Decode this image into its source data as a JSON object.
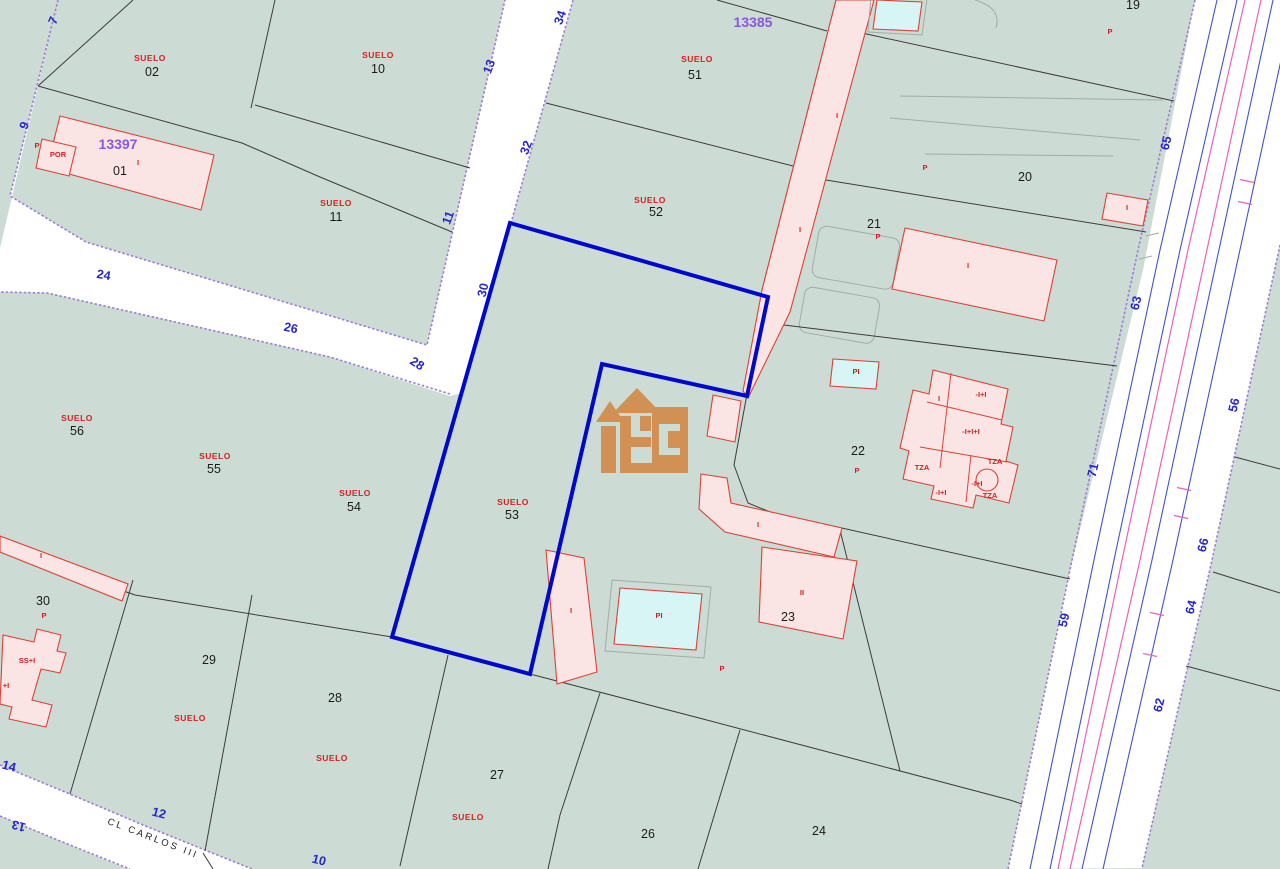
{
  "map": {
    "title": "cadastral-parcel-map",
    "selected_parcel": "53",
    "street_name": "CL CARLOS III",
    "block_codes": [
      "13397",
      "13385"
    ],
    "colors": {
      "parcel-green": "#ccdcd4",
      "street-white": "#ffffff",
      "edge-purple": "#9a7fd4",
      "bound-black": "#3c3c3c",
      "bld-pink": "#fbe5e4",
      "bld-red": "#dd4136",
      "pool-cyan": "#d8f5f5",
      "sel-blue": "#0008cc",
      "road-blue": "#4053cc",
      "road-mag": "#e863b8",
      "gray": "#a3aba7",
      "logo": "#d28d4e",
      "lbl-red": "#d42222",
      "lbl-black": "#1a1a1a",
      "lbl-purple": "#8a56e0",
      "lbl-blue": "#2626c8"
    },
    "labels": [
      {
        "text": "SUELO",
        "x": 150,
        "y": 61,
        "cls": "su",
        "name": "parcel-02-suelo"
      },
      {
        "text": "02",
        "x": 152,
        "y": 76,
        "cls": "num",
        "name": "parcel-02-number"
      },
      {
        "text": "SUELO",
        "x": 378,
        "y": 58,
        "cls": "su",
        "name": "parcel-10-suelo"
      },
      {
        "text": "10",
        "x": 378,
        "y": 73,
        "cls": "num",
        "name": "parcel-10-number"
      },
      {
        "text": "SUELO",
        "x": 336,
        "y": 206,
        "cls": "su",
        "name": "parcel-11-suelo"
      },
      {
        "text": "11",
        "x": 336,
        "y": 221,
        "cls": "num",
        "name": "parcel-11-number"
      },
      {
        "text": "SUELO",
        "x": 697,
        "y": 62,
        "cls": "su",
        "name": "parcel-51-suelo"
      },
      {
        "text": "51",
        "x": 695,
        "y": 79,
        "cls": "num",
        "name": "parcel-51-number"
      },
      {
        "text": "SUELO",
        "x": 650,
        "y": 203,
        "cls": "su",
        "name": "parcel-52-suelo"
      },
      {
        "text": "52",
        "x": 656,
        "y": 216,
        "cls": "num",
        "name": "parcel-52-number"
      },
      {
        "text": "SUELO",
        "x": 77,
        "y": 421,
        "cls": "su",
        "name": "parcel-56-suelo"
      },
      {
        "text": "56",
        "x": 77,
        "y": 435,
        "cls": "num",
        "name": "parcel-56-number"
      },
      {
        "text": "SUELO",
        "x": 215,
        "y": 459,
        "cls": "su",
        "name": "parcel-55-suelo"
      },
      {
        "text": "55",
        "x": 214,
        "y": 473,
        "cls": "num",
        "name": "parcel-55-number"
      },
      {
        "text": "SUELO",
        "x": 355,
        "y": 496,
        "cls": "su",
        "name": "parcel-54-suelo"
      },
      {
        "text": "54",
        "x": 354,
        "y": 511,
        "cls": "num",
        "name": "parcel-54-number"
      },
      {
        "text": "SUELO",
        "x": 513,
        "y": 505,
        "cls": "su",
        "name": "parcel-53-suelo"
      },
      {
        "text": "53",
        "x": 512,
        "y": 519,
        "cls": "num",
        "name": "parcel-53-number"
      },
      {
        "text": "SUELO",
        "x": 190,
        "y": 721,
        "cls": "su",
        "name": "parcel-29-suelo"
      },
      {
        "text": "SUELO",
        "x": 332,
        "y": 761,
        "cls": "su",
        "name": "parcel-28-suelo"
      },
      {
        "text": "SUELO",
        "x": 468,
        "y": 820,
        "cls": "su",
        "name": "parcel-27-suelo"
      },
      {
        "text": "01",
        "x": 120,
        "y": 175,
        "cls": "num",
        "name": "parcel-01-number"
      },
      {
        "text": "30",
        "x": 43,
        "y": 605,
        "cls": "num",
        "name": "parcel-30-number"
      },
      {
        "text": "29",
        "x": 209,
        "y": 664,
        "cls": "num",
        "name": "parcel-29-number"
      },
      {
        "text": "28",
        "x": 335,
        "y": 702,
        "cls": "num",
        "name": "parcel-28-number"
      },
      {
        "text": "27",
        "x": 497,
        "y": 779,
        "cls": "num",
        "name": "parcel-27-number"
      },
      {
        "text": "26",
        "x": 648,
        "y": 838,
        "cls": "num",
        "name": "parcel-26-number"
      },
      {
        "text": "24",
        "x": 819,
        "y": 835,
        "cls": "num",
        "name": "parcel-24-number"
      },
      {
        "text": "19",
        "x": 1133,
        "y": 9,
        "cls": "num",
        "name": "parcel-19-number"
      },
      {
        "text": "20",
        "x": 1025,
        "y": 181,
        "cls": "num",
        "name": "parcel-20-number"
      },
      {
        "text": "21",
        "x": 874,
        "y": 228,
        "cls": "num",
        "name": "parcel-21-number"
      },
      {
        "text": "22",
        "x": 858,
        "y": 455,
        "cls": "num",
        "name": "parcel-22-number"
      },
      {
        "text": "23",
        "x": 788,
        "y": 621,
        "cls": "num",
        "name": "parcel-23-number"
      },
      {
        "text": "13397",
        "x": 118,
        "y": 149,
        "cls": "code",
        "name": "block-code-13397"
      },
      {
        "text": "13385",
        "x": 753,
        "y": 27,
        "cls": "code",
        "name": "block-code-13385"
      },
      {
        "text": "7",
        "x": 57,
        "y": 22,
        "rot": -68,
        "cls": "blue",
        "name": "street-number-7"
      },
      {
        "text": "9",
        "x": 28,
        "y": 127,
        "rot": -68,
        "cls": "blue",
        "name": "street-number-9"
      },
      {
        "text": "24",
        "x": 103,
        "y": 279,
        "rot": 10,
        "cls": "blue",
        "name": "street-number-24"
      },
      {
        "text": "26",
        "x": 290,
        "y": 332,
        "rot": 12,
        "cls": "blue",
        "name": "street-number-26"
      },
      {
        "text": "28",
        "x": 415,
        "y": 367,
        "rot": 33,
        "cls": "blue",
        "name": "street-number-28"
      },
      {
        "text": "30",
        "x": 487,
        "y": 291,
        "rot": -77,
        "cls": "blue",
        "name": "street-number-30"
      },
      {
        "text": "32",
        "x": 530,
        "y": 149,
        "rot": -70,
        "cls": "blue",
        "name": "street-number-32"
      },
      {
        "text": "34",
        "x": 564,
        "y": 19,
        "rot": -70,
        "cls": "blue",
        "name": "street-number-34"
      },
      {
        "text": "13",
        "x": 493,
        "y": 68,
        "rot": -70,
        "cls": "blue",
        "name": "street-number-13"
      },
      {
        "text": "11",
        "x": 452,
        "y": 219,
        "rot": -70,
        "cls": "blue",
        "name": "street-number-11"
      },
      {
        "text": "14",
        "x": 8,
        "y": 770,
        "rot": 15,
        "cls": "blue",
        "name": "street-number-14"
      },
      {
        "text": "12",
        "x": 158,
        "y": 817,
        "rot": 15,
        "cls": "blue",
        "name": "street-number-12"
      },
      {
        "text": "13",
        "x": 20,
        "y": 822,
        "rot": 196,
        "cls": "blue",
        "name": "street-number-13b"
      },
      {
        "text": "10",
        "x": 318,
        "y": 864,
        "rot": 15,
        "cls": "blue",
        "name": "street-number-10"
      },
      {
        "text": "65",
        "x": 1170,
        "y": 144,
        "rot": -77,
        "cls": "blue",
        "name": "road-number-65"
      },
      {
        "text": "63",
        "x": 1140,
        "y": 304,
        "rot": -77,
        "cls": "blue",
        "name": "road-number-63"
      },
      {
        "text": "56",
        "x": 1238,
        "y": 406,
        "rot": -77,
        "cls": "blue",
        "name": "road-number-56"
      },
      {
        "text": "71",
        "x": 1097,
        "y": 471,
        "rot": -77,
        "cls": "blue",
        "name": "road-number-71"
      },
      {
        "text": "66",
        "x": 1207,
        "y": 546,
        "rot": -77,
        "cls": "blue",
        "name": "road-number-66"
      },
      {
        "text": "59",
        "x": 1068,
        "y": 621,
        "rot": -77,
        "cls": "blue",
        "name": "road-number-59"
      },
      {
        "text": "64",
        "x": 1195,
        "y": 608,
        "rot": -77,
        "cls": "blue",
        "name": "road-number-64"
      },
      {
        "text": "62",
        "x": 1163,
        "y": 706,
        "rot": -77,
        "cls": "blue",
        "name": "road-number-62"
      },
      {
        "text": "POR",
        "x": 58,
        "y": 157,
        "cls": "bld",
        "name": "building-label-por"
      },
      {
        "text": "I",
        "x": 138,
        "y": 165,
        "cls": "bld",
        "name": "building-label"
      },
      {
        "text": "P",
        "x": 37,
        "y": 148,
        "cls": "bld",
        "name": "building-label"
      },
      {
        "text": "I",
        "x": 837,
        "y": 118,
        "cls": "bld",
        "name": "building-label"
      },
      {
        "text": "I",
        "x": 800,
        "y": 232,
        "cls": "bld",
        "name": "building-label"
      },
      {
        "text": "P",
        "x": 1110,
        "y": 34,
        "cls": "bld",
        "name": "building-label"
      },
      {
        "text": "P",
        "x": 925,
        "y": 170,
        "cls": "bld",
        "name": "building-label"
      },
      {
        "text": "I",
        "x": 968,
        "y": 268,
        "cls": "bld",
        "name": "building-label"
      },
      {
        "text": "I",
        "x": 1127,
        "y": 210,
        "cls": "bld",
        "name": "building-label"
      },
      {
        "text": "P",
        "x": 878,
        "y": 239,
        "cls": "bld",
        "name": "building-label"
      },
      {
        "text": "P",
        "x": 857,
        "y": 473,
        "cls": "bld",
        "name": "building-label"
      },
      {
        "text": "PI",
        "x": 856,
        "y": 374,
        "cls": "bld",
        "name": "pool-label"
      },
      {
        "text": "I",
        "x": 939,
        "y": 401,
        "cls": "bld",
        "name": "building-label"
      },
      {
        "text": "-I+I",
        "x": 981,
        "y": 397,
        "cls": "bld",
        "name": "building-label"
      },
      {
        "text": "-I+I+I",
        "x": 971,
        "y": 434,
        "cls": "bld",
        "name": "building-label"
      },
      {
        "text": "TZA",
        "x": 922,
        "y": 470,
        "cls": "bld",
        "name": "building-label-tza"
      },
      {
        "text": "TZA",
        "x": 995,
        "y": 464,
        "cls": "bld",
        "name": "building-label-tza"
      },
      {
        "text": "-I+I",
        "x": 977,
        "y": 486,
        "cls": "bld",
        "name": "building-label"
      },
      {
        "text": "-I+I",
        "x": 941,
        "y": 495,
        "cls": "bld",
        "name": "building-label"
      },
      {
        "text": "TZA",
        "x": 990,
        "y": 498,
        "cls": "bld",
        "name": "building-label-tza"
      },
      {
        "text": "I",
        "x": 758,
        "y": 527,
        "cls": "bld",
        "name": "building-label"
      },
      {
        "text": "II",
        "x": 802,
        "y": 595,
        "cls": "bld",
        "name": "building-label"
      },
      {
        "text": "I",
        "x": 571,
        "y": 613,
        "cls": "bld",
        "name": "building-label"
      },
      {
        "text": "PI",
        "x": 659,
        "y": 618,
        "cls": "bld",
        "name": "pool-label"
      },
      {
        "text": "P",
        "x": 722,
        "y": 671,
        "cls": "bld",
        "name": "building-label"
      },
      {
        "text": "SS+I",
        "x": 27,
        "y": 663,
        "cls": "bld",
        "name": "building-label"
      },
      {
        "text": "+I",
        "x": 6,
        "y": 688,
        "cls": "bld",
        "name": "building-label"
      },
      {
        "text": "P",
        "x": 44,
        "y": 618,
        "cls": "bld",
        "name": "building-label"
      },
      {
        "text": "I",
        "x": 41,
        "y": 558,
        "cls": "bld",
        "name": "building-label"
      },
      {
        "text": "CL CARLOS III",
        "x": 152,
        "y": 841,
        "rot": 21,
        "cls": "street",
        "name": "street-name-cl-carlos-iii"
      }
    ]
  }
}
